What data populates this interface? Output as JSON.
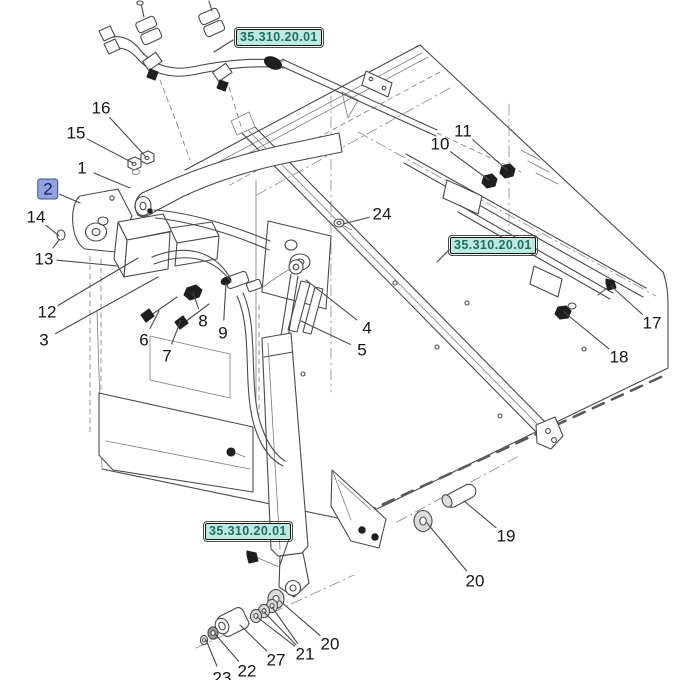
{
  "document": {
    "kind": "exploded-parts-diagram",
    "section_reference": "35.310.20.01"
  },
  "colors": {
    "diagram_line": "#4a4a4a",
    "leader_line": "#2a2a2a",
    "ref_label_bg": "#bee9df",
    "ref_label_text": "#1e6e62",
    "highlight_bg": "#93a3d9",
    "highlight_text": "#101e63",
    "callout_text": "#151515"
  },
  "ref_labels": [
    {
      "text": "35.310.20.01",
      "x": 236,
      "y": 29,
      "leader": {
        "x1": 233,
        "y1": 40,
        "x2": 214,
        "y2": 52
      }
    },
    {
      "text": "35.310.20.01",
      "x": 450,
      "y": 237,
      "leader": {
        "x1": 449,
        "y1": 250,
        "x2": 437,
        "y2": 262
      }
    },
    {
      "text": "35.310.20.01",
      "x": 205,
      "y": 523,
      "leader": {
        "x1": 290,
        "y1": 536,
        "x2": 280,
        "y2": 565
      }
    }
  ],
  "callouts": [
    {
      "label": "16",
      "x": 101,
      "y": 108,
      "highlighted": false,
      "targets": [
        {
          "x": 146,
          "y": 157
        }
      ]
    },
    {
      "label": "15",
      "x": 76,
      "y": 133,
      "highlighted": false,
      "targets": [
        {
          "x": 133,
          "y": 163
        }
      ]
    },
    {
      "label": "1",
      "x": 82,
      "y": 168,
      "highlighted": false,
      "targets": [
        {
          "x": 130,
          "y": 188
        }
      ]
    },
    {
      "label": "2",
      "x": 48,
      "y": 189,
      "highlighted": true,
      "targets": [
        {
          "x": 80,
          "y": 203
        }
      ]
    },
    {
      "label": "14",
      "x": 36,
      "y": 217,
      "highlighted": false,
      "targets": [
        {
          "x": 59,
          "y": 236
        }
      ]
    },
    {
      "label": "13",
      "x": 44,
      "y": 259,
      "highlighted": false,
      "targets": [
        {
          "x": 118,
          "y": 266
        }
      ]
    },
    {
      "label": "12",
      "x": 47,
      "y": 312,
      "highlighted": false,
      "targets": [
        {
          "x": 138,
          "y": 258
        }
      ]
    },
    {
      "label": "3",
      "x": 44,
      "y": 340,
      "highlighted": false,
      "targets": [
        {
          "x": 158,
          "y": 277
        }
      ]
    },
    {
      "label": "6",
      "x": 144,
      "y": 340,
      "highlighted": false,
      "targets": [
        {
          "x": 159,
          "y": 311
        }
      ]
    },
    {
      "label": "7",
      "x": 167,
      "y": 356,
      "highlighted": false,
      "targets": [
        {
          "x": 181,
          "y": 320
        }
      ]
    },
    {
      "label": "8",
      "x": 203,
      "y": 321,
      "highlighted": false,
      "targets": [
        {
          "x": 193,
          "y": 293
        }
      ]
    },
    {
      "label": "9",
      "x": 223,
      "y": 333,
      "highlighted": false,
      "targets": [
        {
          "x": 226,
          "y": 283
        }
      ]
    },
    {
      "label": "24",
      "x": 382,
      "y": 214,
      "highlighted": false,
      "targets": [
        {
          "x": 343,
          "y": 224
        }
      ]
    },
    {
      "label": "4",
      "x": 367,
      "y": 328,
      "highlighted": false,
      "targets": [
        {
          "x": 306,
          "y": 280
        }
      ]
    },
    {
      "label": "5",
      "x": 362,
      "y": 350,
      "highlighted": false,
      "targets": [
        {
          "x": 301,
          "y": 321
        }
      ]
    },
    {
      "label": "10",
      "x": 440,
      "y": 144,
      "highlighted": false,
      "targets": [
        {
          "x": 489,
          "y": 180
        }
      ]
    },
    {
      "label": "11",
      "x": 463,
      "y": 131,
      "highlighted": false,
      "targets": [
        {
          "x": 507,
          "y": 170
        }
      ]
    },
    {
      "label": "17",
      "x": 652,
      "y": 323,
      "highlighted": false,
      "targets": [
        {
          "x": 611,
          "y": 286
        }
      ]
    },
    {
      "label": "18",
      "x": 619,
      "y": 357,
      "highlighted": false,
      "targets": [
        {
          "x": 564,
          "y": 312
        }
      ]
    },
    {
      "label": "19",
      "x": 506,
      "y": 536,
      "highlighted": false,
      "targets": [
        {
          "x": 464,
          "y": 501
        }
      ]
    },
    {
      "label": "20",
      "x": 475,
      "y": 581,
      "highlighted": false,
      "targets": [
        {
          "x": 427,
          "y": 523
        }
      ]
    },
    {
      "label": "20",
      "x": 330,
      "y": 644,
      "highlighted": false,
      "targets": [
        {
          "x": 280,
          "y": 601
        }
      ]
    },
    {
      "label": "21",
      "x": 305,
      "y": 654,
      "highlighted": false,
      "targets": [
        {
          "x": 272,
          "y": 607
        },
        {
          "x": 264,
          "y": 612
        },
        {
          "x": 257,
          "y": 617
        }
      ]
    },
    {
      "label": "27",
      "x": 276,
      "y": 660,
      "highlighted": false,
      "targets": [
        {
          "x": 240,
          "y": 625
        }
      ]
    },
    {
      "label": "22",
      "x": 247,
      "y": 671,
      "highlighted": false,
      "targets": [
        {
          "x": 215,
          "y": 634
        }
      ]
    },
    {
      "label": "23",
      "x": 222,
      "y": 678,
      "highlighted": false,
      "targets": [
        {
          "x": 206,
          "y": 640
        }
      ]
    }
  ]
}
